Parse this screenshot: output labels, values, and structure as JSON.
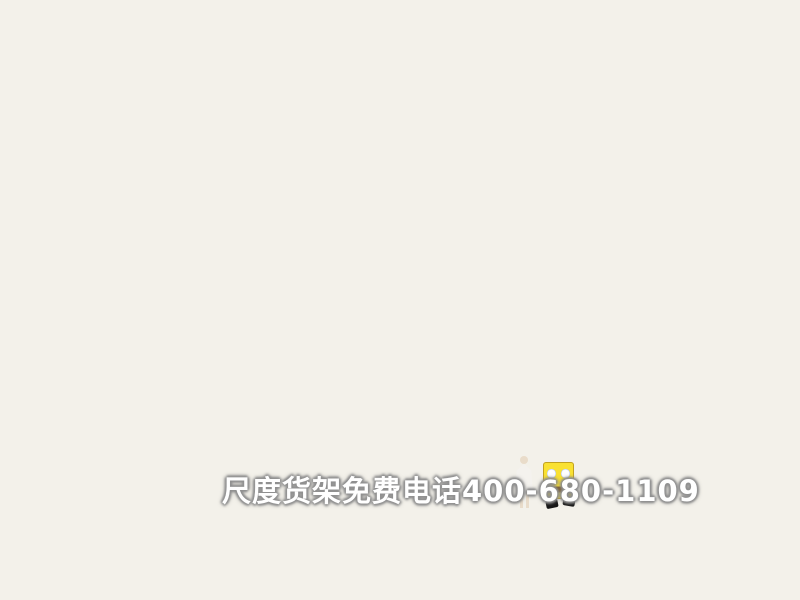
{
  "scene": {
    "type": "3d-store-interior-render",
    "subject": "children's clothing shop with two brand zones on a wooden platform"
  },
  "signs": {
    "locke_teddy": {
      "brand": "Locke Teddy",
      "brand_cn": "洛克泰迪",
      "logo": "teddy-bear-with-blue-top-hat"
    },
    "spongebob": {
      "brand": "SpongeBob",
      "brand_cn": "海绵宝宝"
    }
  },
  "watermark": {
    "text": "尺度货架免费电话400-680-1109"
  },
  "colors": {
    "background_navy": "#0e1126",
    "outside_floor": "#4a5270",
    "wood_floor": "#d8a868",
    "fixture_white": "#f2efe6",
    "back_wall_cream": "#efe8cf",
    "spongebob_yellow": "#f6dc2e",
    "star_accent_orange": "#e9ac40",
    "sign_band_gray": "#8e8e86",
    "denim_blue": "#3c527b",
    "teddy_brown": "#5d3c20",
    "shirt_red": "#b02630",
    "logo_hat_blue": "#2b56c8"
  }
}
